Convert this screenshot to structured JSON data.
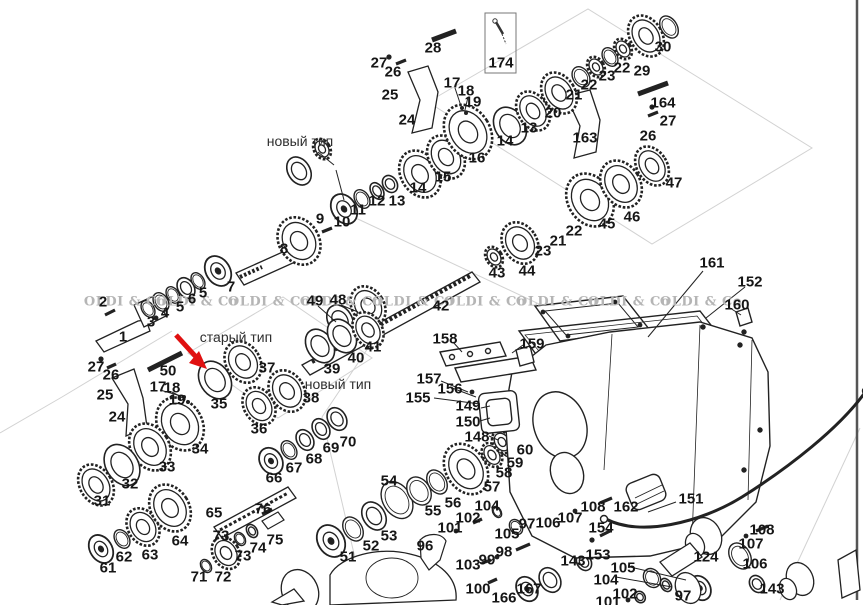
{
  "drawing_title": "gearbox exploded parts diagram",
  "watermark": {
    "text": "OLDI & Co",
    "color": "#b5b5b5",
    "y": 302,
    "xs": [
      125,
      197,
      269,
      341,
      413,
      485,
      557,
      629,
      701
    ]
  },
  "type_labels": [
    {
      "text": "новый тип",
      "x": 300,
      "y": 141
    },
    {
      "text": "старый тип",
      "x": 236,
      "y": 337
    },
    {
      "text": "новый тип",
      "x": 338,
      "y": 384
    }
  ],
  "arrow": {
    "color": "#e01010"
  },
  "part_labels": [
    {
      "n": "1",
      "x": 123,
      "y": 337
    },
    {
      "n": "2",
      "x": 103,
      "y": 302
    },
    {
      "n": "3",
      "x": 151,
      "y": 322
    },
    {
      "n": "4",
      "x": 165,
      "y": 313
    },
    {
      "n": "5",
      "x": 180,
      "y": 307
    },
    {
      "n": "6",
      "x": 192,
      "y": 299
    },
    {
      "n": "5",
      "x": 203,
      "y": 293
    },
    {
      "n": "7",
      "x": 231,
      "y": 287
    },
    {
      "n": "8",
      "x": 284,
      "y": 249
    },
    {
      "n": "9",
      "x": 320,
      "y": 219
    },
    {
      "n": "10",
      "x": 342,
      "y": 222
    },
    {
      "n": "11",
      "x": 358,
      "y": 210
    },
    {
      "n": "12",
      "x": 377,
      "y": 201
    },
    {
      "n": "13",
      "x": 397,
      "y": 201
    },
    {
      "n": "14",
      "x": 418,
      "y": 188
    },
    {
      "n": "15",
      "x": 443,
      "y": 177
    },
    {
      "n": "16",
      "x": 477,
      "y": 158
    },
    {
      "n": "17",
      "x": 452,
      "y": 83
    },
    {
      "n": "18",
      "x": 466,
      "y": 91
    },
    {
      "n": "19",
      "x": 473,
      "y": 102
    },
    {
      "n": "13",
      "x": 529,
      "y": 128
    },
    {
      "n": "14",
      "x": 505,
      "y": 141
    },
    {
      "n": "20",
      "x": 553,
      "y": 113
    },
    {
      "n": "21",
      "x": 574,
      "y": 95
    },
    {
      "n": "22",
      "x": 589,
      "y": 85
    },
    {
      "n": "23",
      "x": 607,
      "y": 76
    },
    {
      "n": "22",
      "x": 622,
      "y": 68
    },
    {
      "n": "29",
      "x": 642,
      "y": 71
    },
    {
      "n": "30",
      "x": 663,
      "y": 47
    },
    {
      "n": "28",
      "x": 433,
      "y": 48
    },
    {
      "n": "27",
      "x": 379,
      "y": 63
    },
    {
      "n": "26",
      "x": 393,
      "y": 72
    },
    {
      "n": "25",
      "x": 390,
      "y": 95
    },
    {
      "n": "24",
      "x": 407,
      "y": 120
    },
    {
      "n": "174",
      "x": 501,
      "y": 63
    },
    {
      "n": "163",
      "x": 585,
      "y": 138
    },
    {
      "n": "164",
      "x": 663,
      "y": 103
    },
    {
      "n": "27",
      "x": 668,
      "y": 121
    },
    {
      "n": "26",
      "x": 648,
      "y": 136
    },
    {
      "n": "47",
      "x": 674,
      "y": 183
    },
    {
      "n": "46",
      "x": 632,
      "y": 217
    },
    {
      "n": "45",
      "x": 607,
      "y": 224
    },
    {
      "n": "22",
      "x": 574,
      "y": 231
    },
    {
      "n": "21",
      "x": 558,
      "y": 241
    },
    {
      "n": "23",
      "x": 543,
      "y": 251
    },
    {
      "n": "43",
      "x": 497,
      "y": 273
    },
    {
      "n": "44",
      "x": 527,
      "y": 271
    },
    {
      "n": "42",
      "x": 441,
      "y": 306
    },
    {
      "n": "49",
      "x": 315,
      "y": 301
    },
    {
      "n": "48",
      "x": 338,
      "y": 300
    },
    {
      "n": "41",
      "x": 373,
      "y": 347
    },
    {
      "n": "40",
      "x": 356,
      "y": 358
    },
    {
      "n": "39",
      "x": 332,
      "y": 369
    },
    {
      "n": "50",
      "x": 168,
      "y": 371
    },
    {
      "n": "27",
      "x": 96,
      "y": 367
    },
    {
      "n": "26",
      "x": 111,
      "y": 375
    },
    {
      "n": "25",
      "x": 105,
      "y": 395
    },
    {
      "n": "24",
      "x": 117,
      "y": 417
    },
    {
      "n": "17",
      "x": 158,
      "y": 387
    },
    {
      "n": "18",
      "x": 172,
      "y": 388
    },
    {
      "n": "19",
      "x": 177,
      "y": 400
    },
    {
      "n": "35",
      "x": 219,
      "y": 404
    },
    {
      "n": "37",
      "x": 267,
      "y": 368
    },
    {
      "n": "36",
      "x": 259,
      "y": 429
    },
    {
      "n": "38",
      "x": 311,
      "y": 398
    },
    {
      "n": "34",
      "x": 200,
      "y": 449
    },
    {
      "n": "33",
      "x": 167,
      "y": 467
    },
    {
      "n": "32",
      "x": 130,
      "y": 484
    },
    {
      "n": "31",
      "x": 102,
      "y": 501
    },
    {
      "n": "65",
      "x": 214,
      "y": 513
    },
    {
      "n": "64",
      "x": 180,
      "y": 541
    },
    {
      "n": "63",
      "x": 150,
      "y": 555
    },
    {
      "n": "62",
      "x": 124,
      "y": 557
    },
    {
      "n": "61",
      "x": 108,
      "y": 568
    },
    {
      "n": "66",
      "x": 274,
      "y": 478
    },
    {
      "n": "67",
      "x": 294,
      "y": 468
    },
    {
      "n": "68",
      "x": 314,
      "y": 459
    },
    {
      "n": "69",
      "x": 331,
      "y": 448
    },
    {
      "n": "70",
      "x": 348,
      "y": 442
    },
    {
      "n": "76",
      "x": 263,
      "y": 509
    },
    {
      "n": "73",
      "x": 221,
      "y": 536
    },
    {
      "n": "75",
      "x": 275,
      "y": 540
    },
    {
      "n": "74",
      "x": 258,
      "y": 548
    },
    {
      "n": "73",
      "x": 243,
      "y": 556
    },
    {
      "n": "71",
      "x": 199,
      "y": 577
    },
    {
      "n": "72",
      "x": 223,
      "y": 577
    },
    {
      "n": "54",
      "x": 389,
      "y": 481
    },
    {
      "n": "56",
      "x": 453,
      "y": 503
    },
    {
      "n": "55",
      "x": 433,
      "y": 511
    },
    {
      "n": "53",
      "x": 389,
      "y": 536
    },
    {
      "n": "52",
      "x": 371,
      "y": 546
    },
    {
      "n": "51",
      "x": 348,
      "y": 557
    },
    {
      "n": "57",
      "x": 492,
      "y": 487
    },
    {
      "n": "58",
      "x": 504,
      "y": 473
    },
    {
      "n": "59",
      "x": 515,
      "y": 463
    },
    {
      "n": "60",
      "x": 525,
      "y": 450
    },
    {
      "n": "148",
      "x": 477,
      "y": 437
    },
    {
      "n": "150",
      "x": 468,
      "y": 422
    },
    {
      "n": "149",
      "x": 468,
      "y": 406
    },
    {
      "n": "155",
      "x": 418,
      "y": 398
    },
    {
      "n": "156",
      "x": 450,
      "y": 389
    },
    {
      "n": "157",
      "x": 429,
      "y": 379
    },
    {
      "n": "158",
      "x": 445,
      "y": 339
    },
    {
      "n": "159",
      "x": 532,
      "y": 344
    },
    {
      "n": "161",
      "x": 712,
      "y": 263
    },
    {
      "n": "152",
      "x": 750,
      "y": 282
    },
    {
      "n": "160",
      "x": 737,
      "y": 305
    },
    {
      "n": "96",
      "x": 425,
      "y": 546
    },
    {
      "n": "104",
      "x": 487,
      "y": 506
    },
    {
      "n": "102",
      "x": 468,
      "y": 518
    },
    {
      "n": "101",
      "x": 450,
      "y": 528
    },
    {
      "n": "105",
      "x": 507,
      "y": 534
    },
    {
      "n": "97",
      "x": 527,
      "y": 524
    },
    {
      "n": "106",
      "x": 548,
      "y": 523
    },
    {
      "n": "107",
      "x": 570,
      "y": 518
    },
    {
      "n": "108",
      "x": 593,
      "y": 507
    },
    {
      "n": "162",
      "x": 626,
      "y": 507
    },
    {
      "n": "151",
      "x": 691,
      "y": 499
    },
    {
      "n": "154",
      "x": 601,
      "y": 528
    },
    {
      "n": "153",
      "x": 598,
      "y": 555
    },
    {
      "n": "143",
      "x": 573,
      "y": 561
    },
    {
      "n": "98",
      "x": 504,
      "y": 552
    },
    {
      "n": "99",
      "x": 487,
      "y": 560
    },
    {
      "n": "103",
      "x": 468,
      "y": 565
    },
    {
      "n": "100",
      "x": 478,
      "y": 589
    },
    {
      "n": "166",
      "x": 504,
      "y": 598
    },
    {
      "n": "167",
      "x": 529,
      "y": 589
    },
    {
      "n": "105",
      "x": 623,
      "y": 568
    },
    {
      "n": "104",
      "x": 606,
      "y": 580
    },
    {
      "n": "102",
      "x": 625,
      "y": 594
    },
    {
      "n": "101",
      "x": 608,
      "y": 602
    },
    {
      "n": "97",
      "x": 683,
      "y": 596
    },
    {
      "n": "124",
      "x": 706,
      "y": 557
    },
    {
      "n": "108",
      "x": 762,
      "y": 530
    },
    {
      "n": "107",
      "x": 751,
      "y": 544
    },
    {
      "n": "106",
      "x": 755,
      "y": 564
    },
    {
      "n": "143",
      "x": 772,
      "y": 589
    }
  ]
}
